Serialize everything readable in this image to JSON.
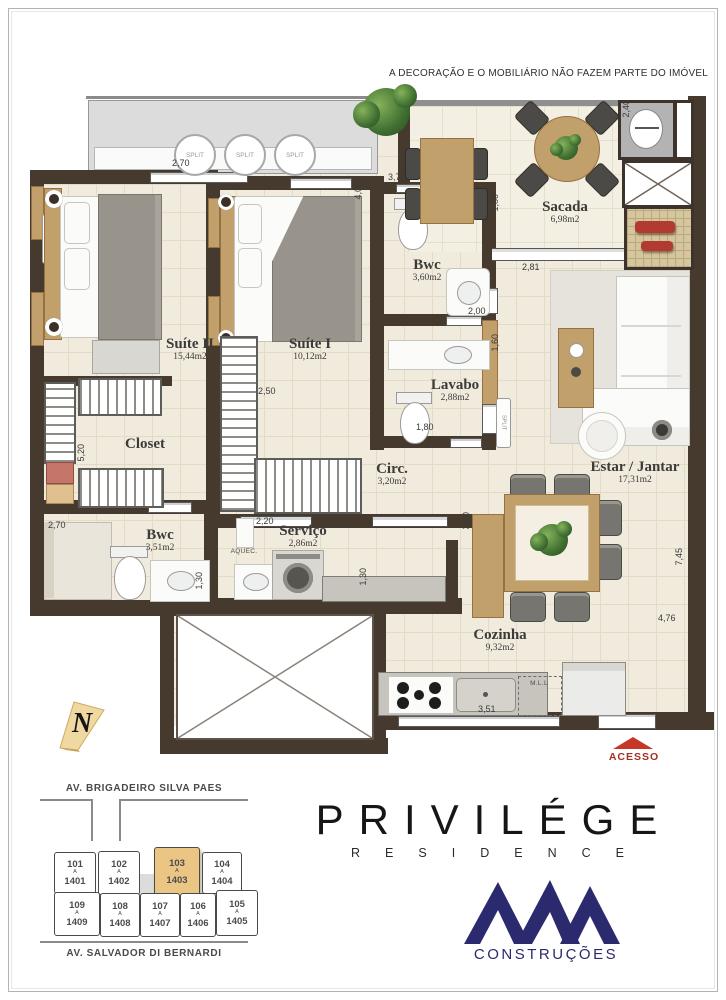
{
  "page": {
    "disclaimer": "A DECORAÇÃO E O MOBILIÁRIO NÃO FAZEM PARTE DO IMÓVEL"
  },
  "colors": {
    "wall": "#46392e",
    "highlight_unit": "#eac584",
    "acesso_red": "#c63726",
    "brand_navy": "#2b2a6e"
  },
  "rooms": {
    "suite2": {
      "name": "Suíte II",
      "area": "15,44m2"
    },
    "suite1": {
      "name": "Suíte I",
      "area": "10,12m2"
    },
    "bwc1": {
      "name": "Bwc",
      "area": "3,60m2"
    },
    "sacada": {
      "name": "Sacada",
      "area": "6,98m2"
    },
    "lavabo": {
      "name": "Lavabo",
      "area": "2,88m2"
    },
    "closet": {
      "name": "Closet"
    },
    "estar": {
      "name": "Estar / Jantar",
      "area": "17,31m2"
    },
    "circ": {
      "name": "Circ.",
      "area": "3,20m2"
    },
    "bwc2": {
      "name": "Bwc",
      "area": "3,51m2"
    },
    "servico": {
      "name": "Serviço",
      "area": "2,86m2"
    },
    "cozinha": {
      "name": "Cozinha",
      "area": "9,32m2"
    }
  },
  "equipment": {
    "split": "SPLIT",
    "aquec": "AQUEC.",
    "mll": "M.L.L"
  },
  "dims": {
    "suite2_top": "2,70",
    "sacada_left": "3,76",
    "suite1_right": "4,05",
    "bwc_h": "1,80",
    "sacada_bottom": "2,81",
    "bwc_w": "2,00",
    "lavabo_h": "1,60",
    "lavabo_w": "1,80",
    "suite1_closet": "2,50",
    "closet_h": "5,20",
    "bwc2_top": "2,70",
    "servico_top": "2,20",
    "bwc2_r": "1,30",
    "servico_r": "1,30",
    "estar_l": "3,20",
    "estar_r": "7,45",
    "kitchen_r": "4,76",
    "top_right": "2,40",
    "kitchen_w": "3,51"
  },
  "compass": {
    "north": "N"
  },
  "access": {
    "label": "ACESSO"
  },
  "siteplan": {
    "street_top": "AV. BRIGADEIRO SILVA PAES",
    "street_bottom": "AV. SALVADOR DI BERNARDI",
    "sep": "A",
    "highlighted_unit": "103",
    "units": [
      {
        "num": "101",
        "to": "1401"
      },
      {
        "num": "102",
        "to": "1402"
      },
      {
        "num": "103",
        "to": "1403"
      },
      {
        "num": "104",
        "to": "1404"
      },
      {
        "num": "109",
        "to": "1409"
      },
      {
        "num": "108",
        "to": "1408"
      },
      {
        "num": "107",
        "to": "1407"
      },
      {
        "num": "106",
        "to": "1406"
      },
      {
        "num": "105",
        "to": "1405"
      }
    ]
  },
  "branding": {
    "name": "PRIVILÉGE",
    "sub": "RESIDENCE",
    "builder": "CONSTRUÇÕES"
  }
}
